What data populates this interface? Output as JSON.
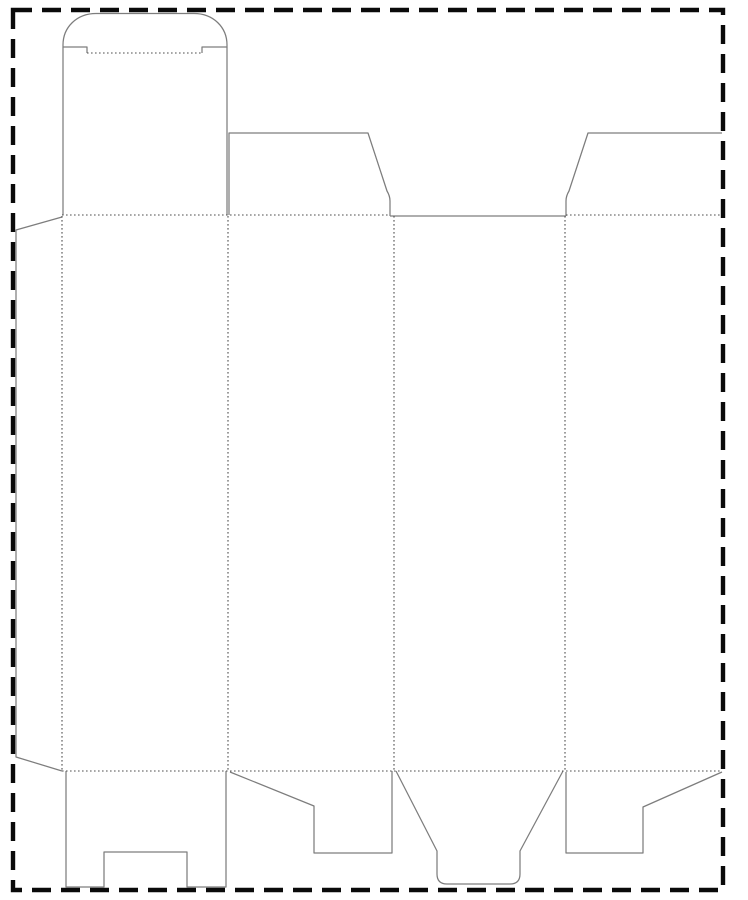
{
  "document": {
    "kind": "packaging-dieline-template",
    "description": "Die-cut carton template: tuck-top lid with rounded tuck flap, four body panels, glue flap, top and bottom dust flaps, snap-lock bottom flap with notch, rounded bottom tuck flap, enclosed by a dashed sheet boundary"
  },
  "canvas": {
    "width": 748,
    "height": 900,
    "background": "#ffffff"
  },
  "styles": {
    "cut": {
      "color": "#7d7d7d",
      "width": 1.25,
      "dash": ""
    },
    "fold": {
      "color": "#4f4f4f",
      "width": 1.1,
      "dash": "1.6 2.4"
    },
    "sheet_border": {
      "color": "#0a0a0a",
      "width": 4.4,
      "dash": "19 10"
    }
  },
  "sheet_border": {
    "x": 13,
    "y": 10,
    "width": 710,
    "height": 880
  },
  "dieline": {
    "cut_paths": [
      {
        "name": "tuck-flap-outline",
        "d": "M 87 53 L 87 47 L 63 47 L 63 45 C 63 27 77 13.5 96 13.5 L 194 13.5 C 213 13.5 227 27 227 45 L 227 47 L 202 47 L 202 53"
      },
      {
        "name": "lid-panel-left-edge",
        "d": "M 63 47 L 63 215"
      },
      {
        "name": "lid-panel-right-edge",
        "d": "M 227 47 L 227 215"
      },
      {
        "name": "glue-flap-outline",
        "d": "M 62 217 L 16 230 L 16 757 L 62 771"
      },
      {
        "name": "top-dust-flap-left",
        "d": "M 229 215 L 229 133 L 368 133 L 387 191 Q 390 196 390 201 L 390 216"
      },
      {
        "name": "panel-3-top-edge",
        "d": "M 390 216 L 566 216"
      },
      {
        "name": "top-dust-flap-right",
        "d": "M 566 216 L 566 201 Q 566 196 569 191 L 588 133 L 722 133"
      },
      {
        "name": "bottom-lock-flap",
        "d": "M 66 771 L 66 887 L 104 887 L 104 852 L 187 852 L 187 887 L 226 887 L 226 771"
      },
      {
        "name": "bottom-dust-flap-left",
        "d": "M 230 772 L 314 806 L 314 853 L 392 853 L 392 771"
      },
      {
        "name": "bottom-tuck-flap",
        "d": "M 396 771 L 437 851 L 437 874 Q 437 884 447 884 L 510 884 Q 520 884 520 874 L 520 851 L 563 771"
      },
      {
        "name": "bottom-dust-flap-right",
        "d": "M 566 772 L 566 853 L 643 853 L 643 807 L 722 772"
      }
    ],
    "fold_lines": [
      {
        "name": "tuck-flap-fold",
        "x1": 87,
        "y1": 53,
        "x2": 202,
        "y2": 53
      },
      {
        "name": "top-fold-left",
        "x1": 62,
        "y1": 215,
        "x2": 390,
        "y2": 215
      },
      {
        "name": "top-fold-right",
        "x1": 566,
        "y1": 215,
        "x2": 722,
        "y2": 215
      },
      {
        "name": "bottom-fold",
        "x1": 62,
        "y1": 771,
        "x2": 722,
        "y2": 771
      },
      {
        "name": "glue-flap-fold",
        "x1": 62,
        "y1": 216,
        "x2": 62,
        "y2": 771
      },
      {
        "name": "panel-1-2-fold",
        "x1": 228,
        "y1": 216,
        "x2": 228,
        "y2": 771
      },
      {
        "name": "panel-2-3-fold",
        "x1": 394,
        "y1": 216,
        "x2": 394,
        "y2": 771
      },
      {
        "name": "panel-3-4-fold",
        "x1": 565,
        "y1": 216,
        "x2": 565,
        "y2": 771
      }
    ]
  }
}
